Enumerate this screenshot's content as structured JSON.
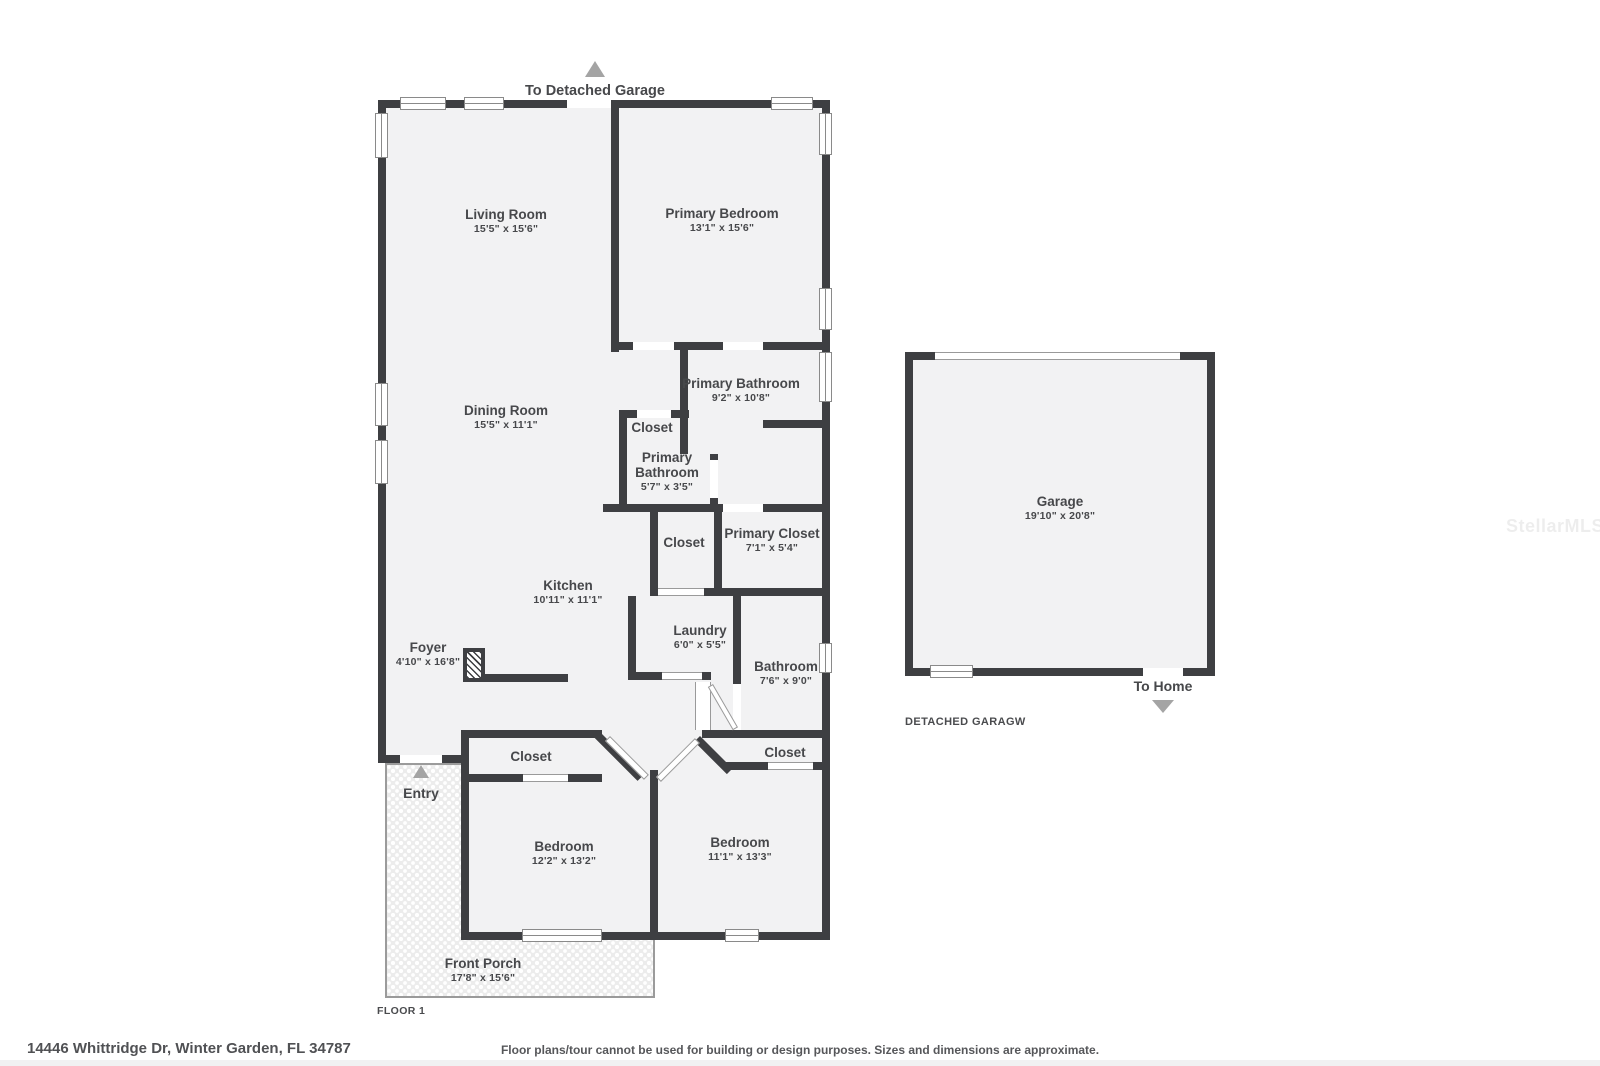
{
  "header": {
    "to_detached_garage": "To Detached Garage"
  },
  "house": {
    "living": {
      "name": "Living Room",
      "dims": "15'5\" x 15'6\""
    },
    "primary_bedroom": {
      "name": "Primary Bedroom",
      "dims": "13'1\" x 15'6\""
    },
    "dining": {
      "name": "Dining Room",
      "dims": "15'5\" x 11'1\""
    },
    "primary_bathroom": {
      "name": "Primary Bathroom",
      "dims": "9'2\" x 10'8\""
    },
    "closet_upper": {
      "name": "Closet"
    },
    "primary_bathroom_small": {
      "name_line1": "Primary",
      "name_line2": "Bathroom",
      "dims": "5'7\" x 3'5\""
    },
    "primary_closet": {
      "name": "Primary Closet",
      "dims": "7'1\" x 5'4\""
    },
    "closet_mid": {
      "name": "Closet"
    },
    "kitchen": {
      "name": "Kitchen",
      "dims": "10'11\" x 11'1\""
    },
    "foyer": {
      "name": "Foyer",
      "dims": "4'10\" x 16'8\""
    },
    "laundry": {
      "name": "Laundry",
      "dims": "6'0\" x 5'5\""
    },
    "bathroom": {
      "name": "Bathroom",
      "dims": "7'6\" x 9'0\""
    },
    "closet_hall_left": {
      "name": "Closet"
    },
    "closet_hall_right": {
      "name": "Closet"
    },
    "bedroom_left": {
      "name": "Bedroom",
      "dims": "12'2\" x 13'2\""
    },
    "bedroom_right": {
      "name": "Bedroom",
      "dims": "11'1\" x 13'3\""
    },
    "front_porch": {
      "name": "Front Porch",
      "dims": "17'8\" x 15'6\""
    },
    "entry": {
      "label": "Entry"
    }
  },
  "garage": {
    "name": "Garage",
    "dims": "19'10\" x 20'8\"",
    "to_home": "To Home",
    "caption": "DETACHED GARAGW"
  },
  "footer": {
    "floor_label": "FLOOR 1",
    "address": "14446 Whittridge Dr, Winter Garden, FL 34787",
    "disclaimer": "Floor plans/tour cannot be used for building or design purposes. Sizes and dimensions are approximate.",
    "watermark": "StellarMLS"
  }
}
